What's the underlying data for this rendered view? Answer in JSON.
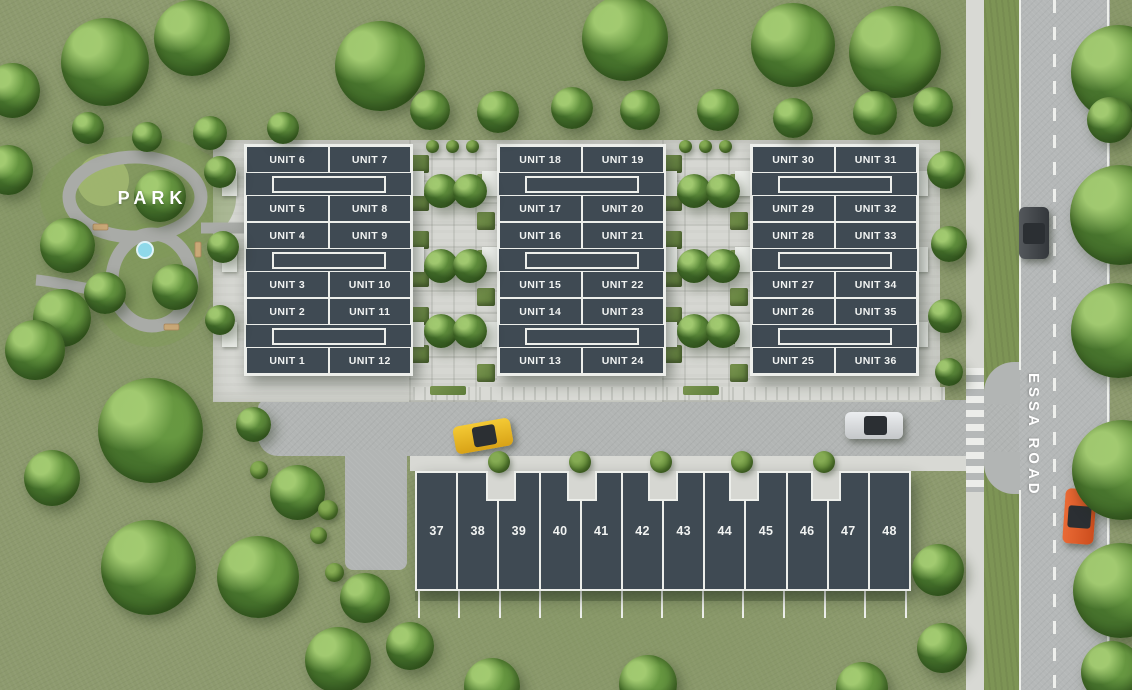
{
  "labels": {
    "park": "PARK",
    "road": "ESSA ROAD"
  },
  "blocks": [
    {
      "rows": [
        {
          "left": "UNIT 6",
          "right": "UNIT 7"
        },
        {
          "left": "UNIT 5",
          "right": "UNIT 8"
        },
        {
          "left": "UNIT 4",
          "right": "UNIT 9"
        },
        {
          "left": "UNIT 3",
          "right": "UNIT 10"
        },
        {
          "left": "UNIT 2",
          "right": "UNIT 11"
        },
        {
          "left": "UNIT 1",
          "right": "UNIT 12"
        }
      ]
    },
    {
      "rows": [
        {
          "left": "UNIT 18",
          "right": "UNIT 19"
        },
        {
          "left": "UNIT 17",
          "right": "UNIT 20"
        },
        {
          "left": "UNIT 16",
          "right": "UNIT 21"
        },
        {
          "left": "UNIT 15",
          "right": "UNIT 22"
        },
        {
          "left": "UNIT 14",
          "right": "UNIT 23"
        },
        {
          "left": "UNIT 13",
          "right": "UNIT 24"
        }
      ]
    },
    {
      "rows": [
        {
          "left": "UNIT 30",
          "right": "UNIT 31"
        },
        {
          "left": "UNIT 29",
          "right": "UNIT 32"
        },
        {
          "left": "UNIT 28",
          "right": "UNIT 33"
        },
        {
          "left": "UNIT 27",
          "right": "UNIT 34"
        },
        {
          "left": "UNIT 26",
          "right": "UNIT 35"
        },
        {
          "left": "UNIT 25",
          "right": "UNIT 36"
        }
      ]
    }
  ],
  "rowhouse": {
    "units": [
      "37",
      "38",
      "39",
      "40",
      "41",
      "42",
      "43",
      "44",
      "45",
      "46",
      "47",
      "48"
    ]
  },
  "colors": {
    "grass": "#8d9a6e",
    "building": "#3f4a53",
    "unit_border": "#edefeb",
    "road": "#b5b8b8",
    "sidewalk": "#d8d9d4",
    "pad": "#d6d7d2",
    "tree": "#4a7329",
    "pond": "#8fd9e9",
    "bench": "#c9a877",
    "car_yellow": "#e9b71f",
    "car_silver": "#d8dadb",
    "car_dark": "#44484c",
    "car_orange": "#e05a27",
    "label_text": "#ffffff"
  }
}
